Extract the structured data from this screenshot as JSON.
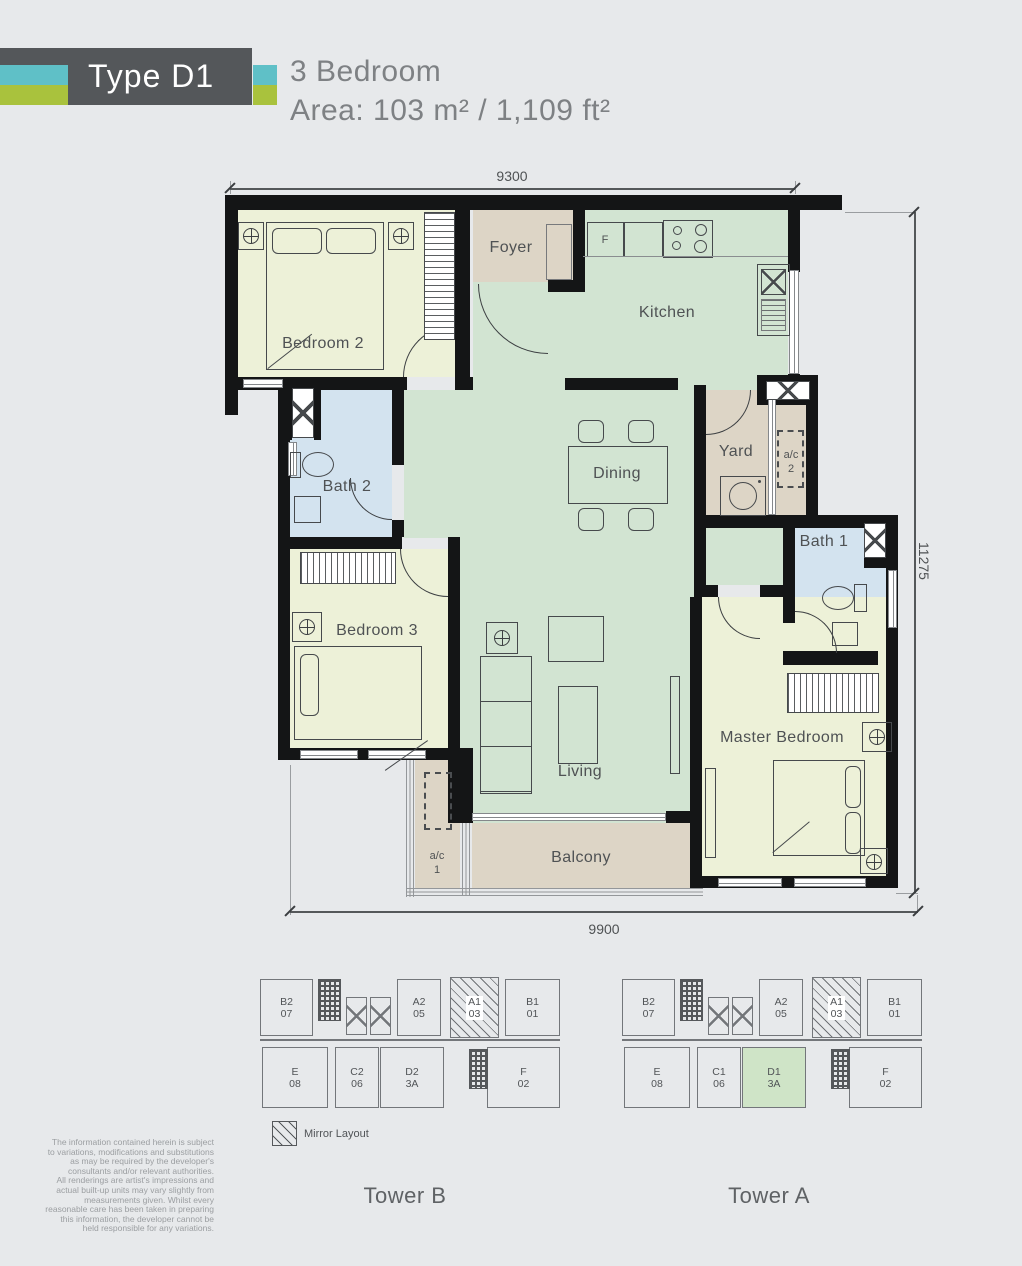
{
  "header": {
    "badge": "Type D1",
    "line1": "3 Bedroom",
    "line2": "Area: 103 m² / 1,109 ft²"
  },
  "plan": {
    "rooms": {
      "bedroom2": "Bedroom 2",
      "foyer": "Foyer",
      "fridge": "F",
      "kitchen": "Kitchen",
      "dining": "Dining",
      "yard": "Yard",
      "ac2a": "a/c",
      "ac2b": "2",
      "bath2": "Bath 2",
      "bedroom3": "Bedroom 3",
      "bath1": "Bath 1",
      "master": "Master Bedroom",
      "living": "Living",
      "balcony": "Balcony",
      "ac1a": "a/c",
      "ac1b": "1"
    },
    "dims": {
      "top": "9300",
      "right": "11275",
      "bottom": "9900"
    }
  },
  "keyplan": {
    "legend": "Mirror Layout",
    "towers": [
      {
        "name": "Tower B",
        "top": [
          [
            "B2",
            "07"
          ],
          [
            "A2",
            "05"
          ],
          [
            "A1",
            "03"
          ],
          [
            "B1",
            "01"
          ]
        ],
        "bottom": [
          [
            "E",
            "08"
          ],
          [
            "C2",
            "06"
          ],
          [
            "D2",
            "3A"
          ],
          [
            "F",
            "02"
          ]
        ],
        "hatched_top_index": 2,
        "highlight_bottom_index": -1
      },
      {
        "name": "Tower A",
        "top": [
          [
            "B2",
            "07"
          ],
          [
            "A2",
            "05"
          ],
          [
            "A1",
            "03"
          ],
          [
            "B1",
            "01"
          ]
        ],
        "bottom": [
          [
            "E",
            "08"
          ],
          [
            "C1",
            "06"
          ],
          [
            "D1",
            "3A"
          ],
          [
            "F",
            "02"
          ]
        ],
        "hatched_top_index": 2,
        "highlight_bottom_index": 2
      }
    ]
  },
  "disclaimer": [
    "The information contained herein is subject",
    "to variations, modifications and substitutions",
    "as may be required by the developer's",
    "consultants and/or relevant authorities.",
    "All renderings are artist's impressions and",
    "actual built-up units may vary slightly from",
    "measurements given. Whilst every",
    "reasonable care has been taken in preparing",
    "this information, the developer cannot be",
    "held responsible for any variations."
  ],
  "colors": {
    "accent_teal": "#5fc0c7",
    "accent_lime": "#a9c23d",
    "header_dark": "#54575a",
    "room_green": "#d2e4d2",
    "room_yellow": "#edf1d8",
    "room_tan": "#ddd5c6",
    "room_blue": "#d3e3ef",
    "highlight_green": "#cfe4c7"
  }
}
